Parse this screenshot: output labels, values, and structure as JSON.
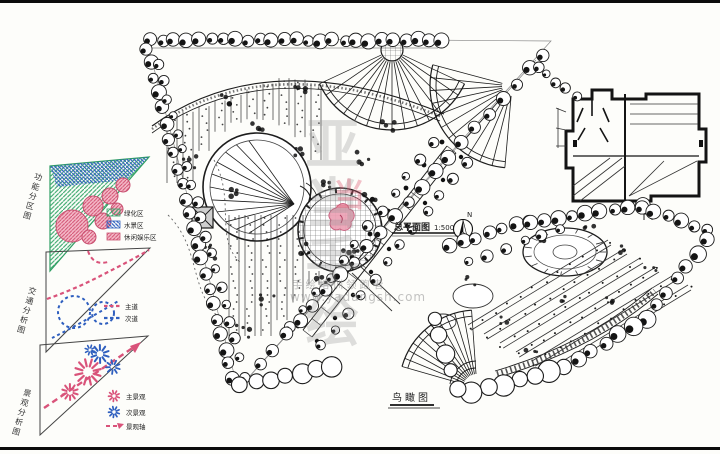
{
  "diagrams": {
    "zoning": {
      "label": "功能分区图",
      "legend": [
        {
          "name": "绿化区",
          "color": "#2f9e63"
        },
        {
          "name": "水景区",
          "color": "#2f5fbf"
        },
        {
          "name": "休闲娱乐区",
          "color": "#d9537a"
        }
      ]
    },
    "traffic": {
      "label": "交通分析图",
      "legend": [
        {
          "name": "主道",
          "color": "#d9537a"
        },
        {
          "name": "次道",
          "color": "#2f5fbf"
        }
      ]
    },
    "landscape": {
      "label": "景观分析图",
      "legend": [
        {
          "name": "主景观",
          "color": "#d9537a"
        },
        {
          "name": "次景观",
          "color": "#2f5fbf"
        },
        {
          "name": "景观轴",
          "color": "#d9537a"
        }
      ]
    }
  },
  "master_plan": {
    "title": "总平面图",
    "scale": "1:500",
    "north": "N"
  },
  "birdseye": {
    "label": "鸟瞰图"
  },
  "watermark": {
    "brand": "亚当手绘",
    "mark": "当",
    "tagline": "手绘培训领跑者",
    "url": "www.yadangsh.com"
  },
  "colors": {
    "ink": "#1c1c1c",
    "green": "#2f9e63",
    "blue": "#2f5fbf",
    "pink": "#d9537a"
  }
}
